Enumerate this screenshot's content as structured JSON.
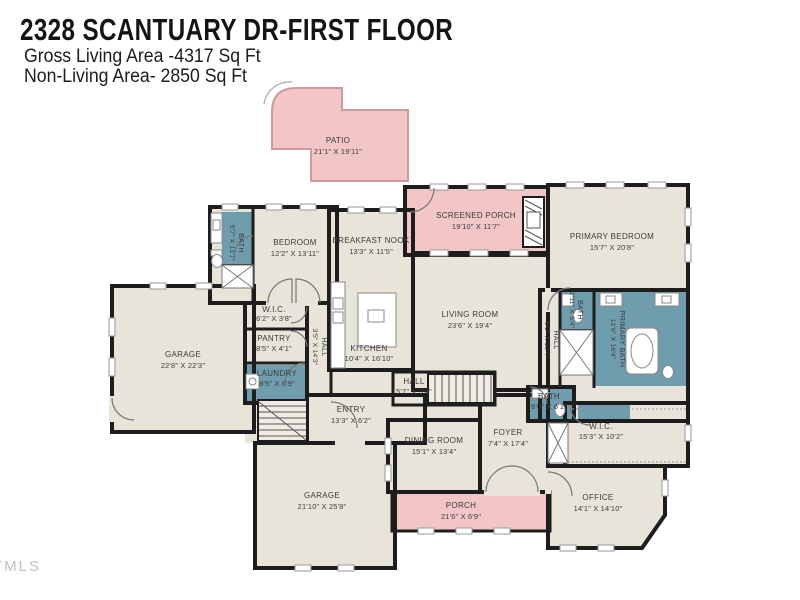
{
  "header": {
    "title": "2328 SCANTUARY DR-FIRST FLOOR",
    "gross_living": "Gross Living Area -4317 Sq Ft",
    "non_living": "Non-Living Area- 2850 Sq Ft"
  },
  "watermark": "TMLS",
  "colors": {
    "wall": "#1d1d1d",
    "interior": "#e9e4da",
    "wet_rooms": "#6f9dad",
    "outdoor": "#f2c5c7",
    "outdoor_outline": "#c99b9e"
  },
  "rooms": [
    {
      "name": "PATIO",
      "dims": "21'1\" X 19'11\""
    },
    {
      "name": "SCREENED PORCH",
      "dims": "19'10\" X 11'7\""
    },
    {
      "name": "PRIMARY BEDROOM",
      "dims": "15'7\" X 20'8\""
    },
    {
      "name": "BATH",
      "dims": "5'7\" X 11'7\""
    },
    {
      "name": "BEDROOM",
      "dims": "12'2\" X 13'11\""
    },
    {
      "name": "BREAKFAST NOOK",
      "dims": "13'3\" X 11'5\""
    },
    {
      "name": "LIVING ROOM",
      "dims": "23'6\" X 19'4\""
    },
    {
      "name": "W.I.C.",
      "dims": "6'2\" X 3'8\""
    },
    {
      "name": "PANTRY",
      "dims": "8'5\" X 4'1\""
    },
    {
      "name": "LAUNDRY",
      "dims": "8'5\" X 6'9\""
    },
    {
      "name": "HALL",
      "dims": "3'5\" X 14'3\""
    },
    {
      "name": "KITCHEN",
      "dims": "10'4\" X 16'10\""
    },
    {
      "name": "GARAGE",
      "dims": "22'8\" X 22'3\""
    },
    {
      "name": "ENTRY",
      "dims": "13'3\" X 6'2\""
    },
    {
      "name": "HALL",
      "dims": "5'7\" X 3'4\""
    },
    {
      "name": "DINING ROOM",
      "dims": "15'1\" X 13'4\""
    },
    {
      "name": "FOYER",
      "dims": "7'4\" X 17'4\""
    },
    {
      "name": "BATH",
      "dims": "2'11\" X 5'4\""
    },
    {
      "name": "PRIMARY BATH",
      "dims": "12'6\" X 16'4\""
    },
    {
      "name": "HALL",
      "dims": "6'0\" X 10'4\""
    },
    {
      "name": "BATH",
      "dims": "6'0\" X 6'1\""
    },
    {
      "name": "W.I.C.",
      "dims": "15'3\" X 10'2\""
    },
    {
      "name": "OFFICE",
      "dims": "14'1\" X 14'10\""
    },
    {
      "name": "GARAGE",
      "dims": "21'10\" X 25'8\""
    },
    {
      "name": "PORCH",
      "dims": "21'6\" X 6'9\""
    }
  ]
}
